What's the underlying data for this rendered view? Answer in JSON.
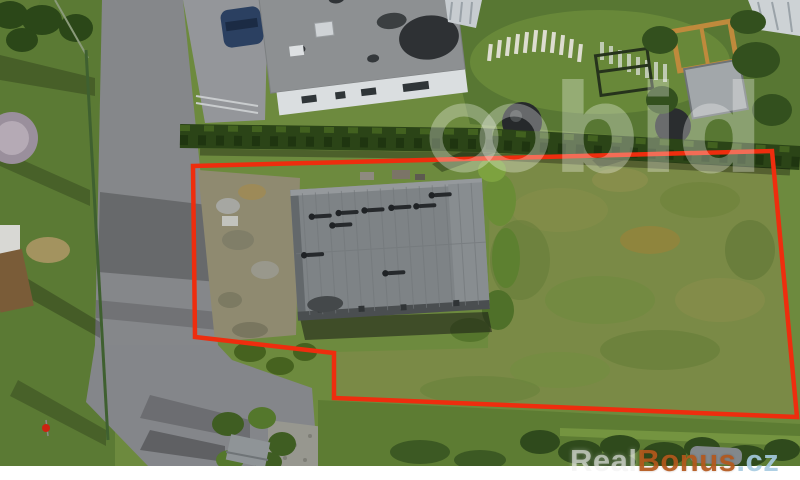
{
  "image": {
    "kind": "aerial drone photograph of a building plot for sale",
    "width_px": 800,
    "height_px": 480,
    "photo_height_px": 466
  },
  "watermark_center": {
    "text": "bid",
    "logo": "two-overlapping-rings",
    "color": "rgba(255,255,255,0.30)"
  },
  "watermark_corner": {
    "real": "Real",
    "bonus": "Bonus",
    "tld": ".cz",
    "real_color": "rgba(240,240,240,0.60)",
    "bonus_color": "#b4571c",
    "tld_color": "#a7cbe2"
  },
  "boundary": {
    "description": "red outline of the offered plot, rectangle with notch at bottom-left",
    "color": "#ee2d0e",
    "stroke_width": 4.5,
    "points": "193,166 772,151 797,417 334,398 334,353 195,337"
  },
  "scene": {
    "elements": [
      "access road",
      "asphalt parking area",
      "neighbouring house with grey flat roof",
      "dark blue car",
      "garden playground with white picket fences",
      "wooden pergola",
      "garden shed",
      "hedge row",
      "main grey flat-roof building inside plot",
      "bare dirt yard",
      "overgrown grass field",
      "small outbuilding in bushes",
      "white bottom margin"
    ],
    "palette": {
      "lawn": "#5b7a34",
      "garden_lawn": "#587733",
      "field": "#7a8a46",
      "asphalt": "#85878a",
      "roof_main": "#7e8386",
      "roof_neighbor": "#8d9092",
      "hedge": "#2b4417",
      "dirt": "#8f8a70",
      "car_blue": "#2b4061",
      "pergola_wood": "#bf8a3c",
      "boundary_red": "#ee2d0e"
    }
  }
}
